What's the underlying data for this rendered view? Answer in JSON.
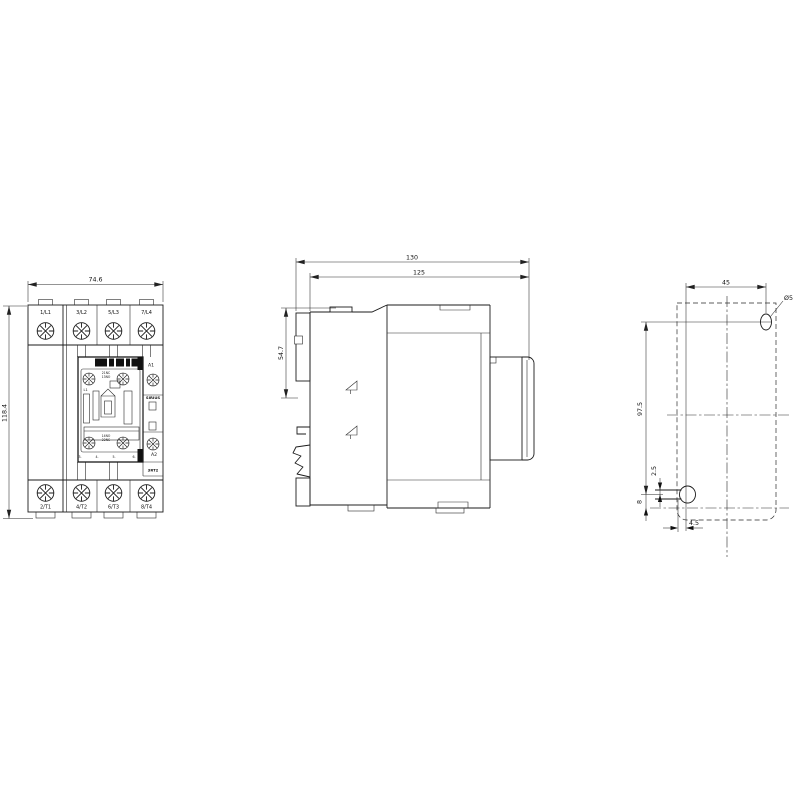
{
  "front_view": {
    "dim_width": "74.6",
    "dim_height": "118.4",
    "top_terminals": [
      "1/L1",
      "3/L2",
      "5/L3",
      "7/L4"
    ],
    "bottom_terminals": [
      "2/T1",
      "4/T2",
      "6/T3",
      "8/T4"
    ],
    "coil_terminal_top": "A1",
    "coil_terminal_bottom": "A2",
    "brand": "SIRIUS",
    "series": "3RT2",
    "coil_marking": "L1",
    "aux_marking_top_1": "21NC",
    "aux_marking_top_2": "13NO",
    "aux_marking_bottom_1": "14NO",
    "aux_marking_bottom_2": "22NC",
    "pole_marks": [
      "3.",
      "4.",
      "5.",
      "6."
    ]
  },
  "side_view": {
    "dim_depth_total": "130",
    "dim_depth_body": "125",
    "dim_top_to_rail": "54.7"
  },
  "drill_plan": {
    "dim_hole_spacing_horizontal": "45",
    "dim_hole_spacing_vertical": "97.5",
    "hole_diameter": "Ø5",
    "dim_slot_offset": "2.5",
    "dim_slot_to_edge": "8",
    "dim_slot_length": "4.5"
  }
}
